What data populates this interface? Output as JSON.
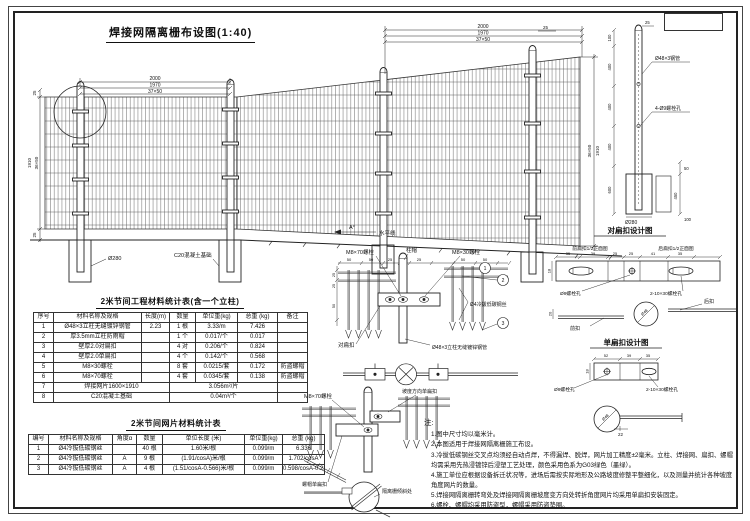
{
  "sheet": {
    "main_title": "焊接网隔离栅布设图(1:40)"
  },
  "elevation": {
    "dims_top_left": [
      "2000",
      "1970",
      "37×50"
    ],
    "dims_top_right": [
      "2000",
      "1970",
      "37×50"
    ],
    "dim_left_top": "25",
    "dim_left_mid1": "1910",
    "dim_left_mid2": "36×50",
    "dim_left_bot": "25",
    "dim_right_top": "25",
    "dim_right_mid1": "36×50",
    "dim_right_mid2": "1910",
    "angle_label": "A°",
    "horizon_label": "水平线",
    "foundation_dia": "Ø280",
    "foundation_label": "C20混凝土基础"
  },
  "detail_top": {
    "bolt70": "M8×70螺栓",
    "cap": "柱帽",
    "bolt30": "M8×30螺栓",
    "callout1": "1",
    "callout2": "2",
    "callout3": "3",
    "wire_label": "Ø4冷拔低碳钢丝",
    "post_label": "Ø48×3立柱无缝镀锌钢管",
    "buckle_label": "对扁扣",
    "dims": [
      "50",
      "50",
      "25",
      "25",
      "50",
      "50"
    ],
    "dims_left": [
      "25",
      "25",
      "50"
    ]
  },
  "detail_slope": {
    "bolt70": "M8×70螺栓",
    "slope_buckle": "坡度方向单扁扣",
    "cap_buckle": "螺帽单扁扣",
    "incline_label": "隔离栅倾斜处"
  },
  "buckle_double": {
    "title": "对扁扣设计图",
    "front_view": "前扁扣1/2正面图",
    "back_view": "后扁扣1/2正面图",
    "dims": [
      "35",
      "39",
      "25",
      "25",
      "41",
      "35"
    ],
    "dim_h": "18",
    "dim_sec": "20",
    "hole9": "Ø9螺栓孔",
    "hole1030": "2-10×30螺栓孔",
    "back": "后扣",
    "front": "前扣",
    "dia": "Ø48"
  },
  "buckle_single": {
    "title": "单扁扣设计图",
    "dims": [
      "52",
      "39",
      "35"
    ],
    "dim_h": "18",
    "dim_tail": "22",
    "hole9": "Ø9螺栓孔",
    "hole1030": "2-10×30螺栓孔",
    "dia": "Ø48"
  },
  "post_detail": {
    "pipe": "Ø48×3钢管",
    "holes": "4-Ø9螺栓孔",
    "dims_left": [
      "100",
      "400",
      "400",
      "400",
      "600"
    ],
    "dim_top": "25",
    "dims_right": [
      "50",
      "450",
      "100"
    ],
    "base_dia": "Ø280"
  },
  "table1": {
    "title": "2米节间工程材料统计表(含一个立柱)",
    "headers": [
      "序号",
      "材料名称及规格",
      "长度(m)",
      "数量",
      "单位重(kg)",
      "总重 (kg)",
      "备注"
    ],
    "rows": [
      [
        "1",
        "Ø48×3立柱无缝镀锌钢管",
        "2.23",
        "1 根",
        "3.33/m",
        "7.426",
        ""
      ],
      [
        "2",
        "厚3.5mm立柱防雨帽",
        "",
        "1 个",
        "0.017/个",
        "0.017",
        ""
      ],
      [
        "3",
        "壁厚2.0对扁扣",
        "",
        "4 对",
        "0.206/个",
        "0.824",
        ""
      ],
      [
        "4",
        "壁厚2.0单扁扣",
        "",
        "4 个",
        "0.142/个",
        "0.568",
        ""
      ],
      [
        "5",
        "M8×30螺栓",
        "",
        "8 套",
        "0.0215/套",
        "0.172",
        "防盗螺帽"
      ],
      [
        "6",
        "M8×70螺栓",
        "",
        "4 套",
        "0.0345/套",
        "0.138",
        "防盗螺帽"
      ]
    ],
    "span_rows": [
      {
        "no": "7",
        "name": "焊接网片1600×1910",
        "value": "3.056m²/片",
        "remark": ""
      },
      {
        "no": "8",
        "name": "C20混凝土基础",
        "value": "0.04m³/个",
        "remark": ""
      }
    ]
  },
  "table2": {
    "title": "2米节间网片材料统计表",
    "headers": [
      "编号",
      "材料名称及规格",
      "角度α",
      "数量",
      "单位长度 (米)",
      "单位重(kg)",
      "总重 (kg)"
    ],
    "rows": [
      [
        "1",
        "Ø4冷拔低碳钢丝",
        "",
        "40 根",
        "1.60米/根",
        "0.099/m",
        "6.336"
      ],
      [
        "2",
        "Ø4冷拔低碳钢丝",
        "A",
        "9 根",
        "(1.91/cosA)米/根",
        "0.099/m",
        "1.702/cosA"
      ],
      [
        "3",
        "Ø4冷拔低碳钢丝",
        "A",
        "4 根",
        "(1.51/cosA-0.566)米/根",
        "0.099/m",
        "0.598/cosA-0.224"
      ]
    ]
  },
  "notes": {
    "heading": "注:",
    "items": [
      "1.图中尺寸均以毫米计。",
      "2.本图适用于焊接网隔离栅施工布设。",
      "3.冷拔低碳钢丝交叉点均须经自动点焊，不得漏焊、脱焊，网片加工精度±2毫米。立柱、焊接网、扁扣、螺帽均需采用先热浸镀锌后浸塑工艺处理，颜色采用色系为G03绿色（墨绿）。",
      "4.施工单位应根据设备拆迁状况等，进场后需按实际地形及公路坡度修整平整细化，以及测量并统计各种坡度角度网片的数量。",
      "5.焊接网隔离栅转弯处及焊接网隔离栅坡度变方向处转折角度网片均采用单扁扣安装固定。",
      "6.螺栓、螺帽均采用防盗型，螺帽采用防盗垫圈。"
    ]
  }
}
